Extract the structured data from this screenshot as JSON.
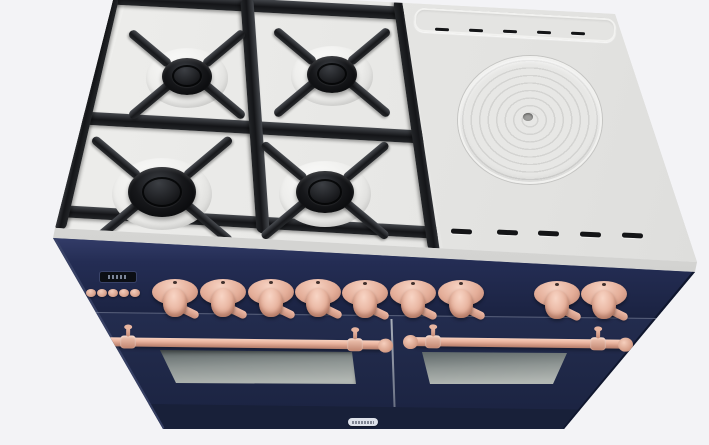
{
  "meta": {
    "type": "3d-product-render",
    "subject": "freestanding dual-fuel range cooker",
    "finish": "midnight blue body with copper knobs, handles and trim",
    "view": "front three-quarter view from above",
    "background_color": "#f3f3f6"
  },
  "colors": {
    "body_navy": "#232c4e",
    "control_panel_navy": "#202950",
    "cooktop_gray": "#e8e8e6",
    "grate_black": "#17181b",
    "copper_trim": "#ecbfab",
    "oven_glass_gray": "#9aa19d",
    "display_black": "#0b0e14"
  },
  "cooktop": {
    "gas_section": {
      "burner_count": 4,
      "burners": [
        {
          "x": 187,
          "y": 76,
          "cap": 25,
          "well": 41,
          "fl": 52
        },
        {
          "x": 332,
          "y": 74,
          "cap": 25,
          "well": 41,
          "fl": 52
        },
        {
          "x": 162,
          "y": 192,
          "cap": 34,
          "well": 50,
          "fl": 60
        },
        {
          "x": 325,
          "y": 192,
          "cap": 29,
          "well": 46,
          "fl": 56
        }
      ],
      "grate_rails": [
        {
          "x": 255,
          "y": 5,
          "l": 300,
          "w": 13,
          "rot": "3deg"
        },
        {
          "x": 252,
          "y": 127,
          "l": 360,
          "w": 13,
          "rot": "3.2deg"
        },
        {
          "x": 250,
          "y": 222,
          "l": 382,
          "w": 12,
          "rot": "3.3deg"
        },
        {
          "x": 86,
          "y": 112,
          "l": 240,
          "w": 13,
          "rot": "-77deg"
        },
        {
          "x": 255,
          "y": 115,
          "l": 236,
          "w": 13,
          "rot": "86deg"
        },
        {
          "x": 418,
          "y": 124,
          "l": 256,
          "w": 15,
          "rot": "82deg"
        }
      ]
    },
    "griddle_section": {
      "french_plate": {
        "x": 528,
        "y": 118,
        "rx": 70,
        "ry": 62,
        "center_dot": true
      },
      "vent_slots_top": {
        "count": 5,
        "items": [
          {
            "x": 442,
            "y": 28,
            "w": 14,
            "h": 3
          },
          {
            "x": 476,
            "y": 29,
            "w": 14,
            "h": 3
          },
          {
            "x": 510,
            "y": 30,
            "w": 14,
            "h": 3
          },
          {
            "x": 544,
            "y": 31,
            "w": 14,
            "h": 3
          },
          {
            "x": 578,
            "y": 32,
            "w": 14,
            "h": 3
          }
        ]
      },
      "vent_slots_bottom": {
        "count": 5,
        "items": [
          {
            "x": 461,
            "y": 229,
            "w": 21,
            "h": 4.5
          },
          {
            "x": 507,
            "y": 230,
            "w": 21,
            "h": 4.5
          },
          {
            "x": 548,
            "y": 231,
            "w": 21,
            "h": 4.5
          },
          {
            "x": 590,
            "y": 232,
            "w": 21,
            "h": 4.5
          },
          {
            "x": 632,
            "y": 233,
            "w": 21,
            "h": 4.5
          }
        ]
      }
    }
  },
  "control_panel": {
    "display": {
      "present": true,
      "legible": false
    },
    "buttons": {
      "count": 5,
      "items": [
        {
          "x": 91,
          "y": 293
        },
        {
          "x": 102,
          "y": 293
        },
        {
          "x": 113,
          "y": 293
        },
        {
          "x": 124,
          "y": 293
        },
        {
          "x": 135,
          "y": 293
        }
      ]
    },
    "knobs": {
      "count": 9,
      "items": [
        {
          "x": 175,
          "y": 292
        },
        {
          "x": 223,
          "y": 292
        },
        {
          "x": 271,
          "y": 292
        },
        {
          "x": 318,
          "y": 292
        },
        {
          "x": 365,
          "y": 293
        },
        {
          "x": 413,
          "y": 293
        },
        {
          "x": 461,
          "y": 293
        },
        {
          "x": 557,
          "y": 294
        },
        {
          "x": 604,
          "y": 294
        }
      ]
    }
  },
  "oven": {
    "door_count": 2,
    "handles": [
      {
        "x1": 88,
        "x2": 390,
        "y": 341,
        "p1": 128,
        "p2": 355
      },
      {
        "x1": 406,
        "x2": 630,
        "y": 341,
        "p1": 433,
        "p2": 598
      }
    ],
    "wordmark_text": ""
  }
}
